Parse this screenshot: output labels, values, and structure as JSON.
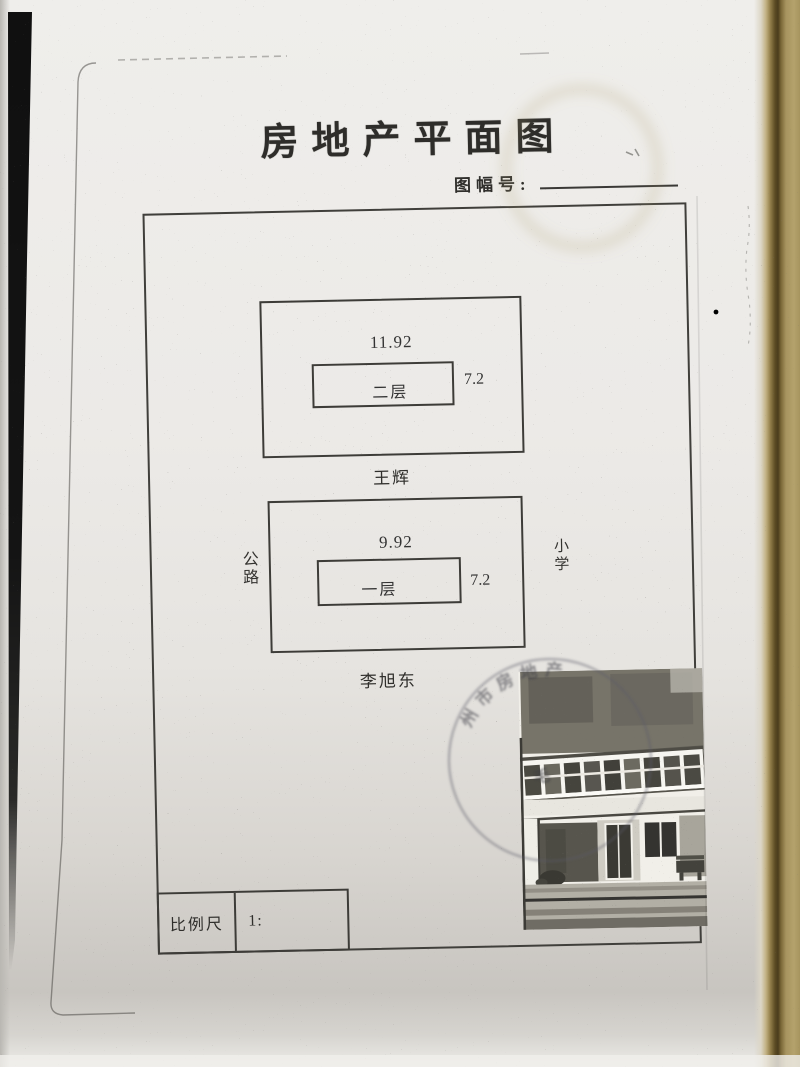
{
  "page": {
    "title": "房地产平面图",
    "sheet_no_label": "图幅号:",
    "sheet_no_value": ""
  },
  "plan": {
    "buildings": [
      {
        "floor_label": "二层",
        "width_dim": "11.92",
        "side_dim": "7.2",
        "owner": "王辉"
      },
      {
        "floor_label": "一层",
        "width_dim": "9.92",
        "side_dim": "7.2",
        "owner": "李旭东"
      }
    ],
    "left_label": "公路",
    "right_label": "小学"
  },
  "scale": {
    "label": "比例尺",
    "value_prefix": "1:",
    "value": ""
  },
  "stamp": {
    "arc_text": "州市房地产",
    "partial_char": "毛"
  },
  "colors": {
    "ink": "#343330",
    "paper": "#e9e8e4",
    "book_edge": "#a08c58",
    "stamp_ink": "#5c5c68"
  }
}
